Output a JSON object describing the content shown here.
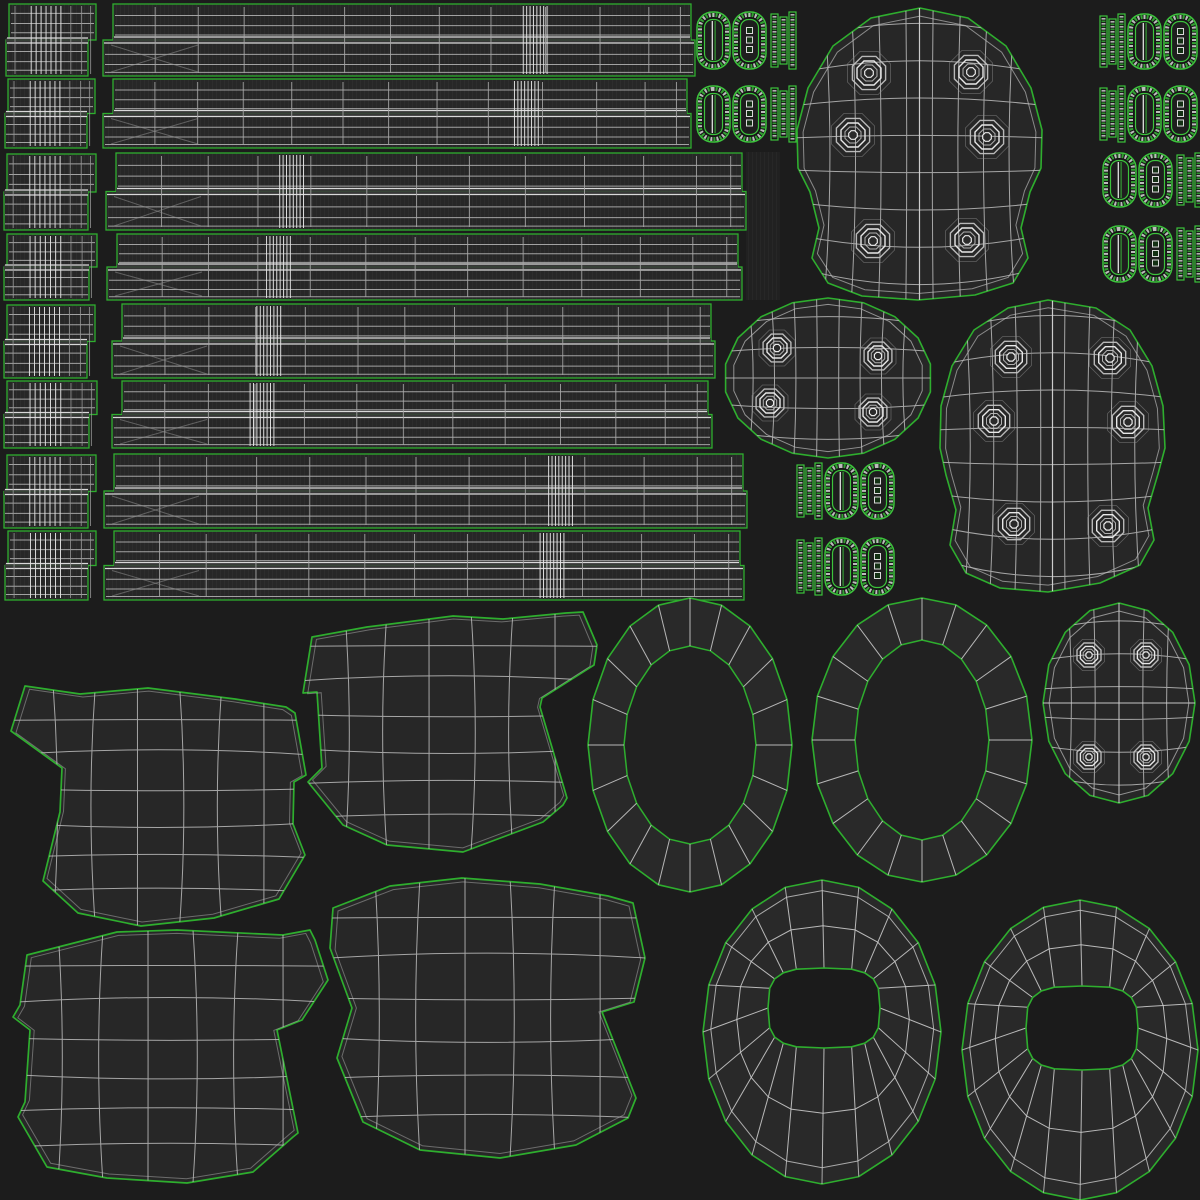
{
  "meta": {
    "title": "uv-wireframe-texture-sheet",
    "canvas": {
      "width": 1200,
      "height": 1200
    }
  },
  "colors": {
    "background": "#1c1c1c",
    "island_fill": "#272727",
    "island_texture_line": "#2d2d2d",
    "hardware_fill": "#161616",
    "ring_band_fill": "#292929",
    "ring_center_fill": "#212121",
    "hole_fill": "#1b1b1b",
    "seam_green": "#2eae2e",
    "seam_green_bright": "#3cc43c",
    "wire": "#c0c0c0",
    "wire_bright": "#e8e8e8",
    "wire_dim": "#8f8f8f",
    "band_fill": "#383838",
    "band_line": "#d8d8d8",
    "texture_block_fill": "#212121",
    "texture_block_line": "#272727"
  },
  "shapes": {
    "strip_rows": [
      {
        "block": {
          "x": 6,
          "y": 4,
          "w": 90,
          "h": 72
        },
        "strip": {
          "x": 103,
          "y": 4,
          "w": 592,
          "h": 72
        },
        "cluster_fx": 0.73
      },
      {
        "block": {
          "x": 5,
          "y": 79,
          "w": 90,
          "h": 69
        },
        "strip": {
          "x": 103,
          "y": 79,
          "w": 588,
          "h": 69
        },
        "cluster_fx": 0.72
      },
      {
        "block": {
          "x": 4,
          "y": 154,
          "w": 92,
          "h": 76
        },
        "strip": {
          "x": 106,
          "y": 153,
          "w": 640,
          "h": 77
        },
        "cluster_fx": 0.29
      },
      {
        "block": {
          "x": 4,
          "y": 234,
          "w": 93,
          "h": 66
        },
        "strip": {
          "x": 107,
          "y": 234,
          "w": 635,
          "h": 66
        },
        "cluster_fx": 0.27
      },
      {
        "block": {
          "x": 4,
          "y": 305,
          "w": 91,
          "h": 73
        },
        "strip": {
          "x": 112,
          "y": 304,
          "w": 603,
          "h": 74
        },
        "cluster_fx": 0.26
      },
      {
        "block": {
          "x": 4,
          "y": 381,
          "w": 93,
          "h": 67
        },
        "strip": {
          "x": 112,
          "y": 381,
          "w": 600,
          "h": 67
        },
        "cluster_fx": 0.25
      },
      {
        "block": {
          "x": 4,
          "y": 455,
          "w": 92,
          "h": 73
        },
        "strip": {
          "x": 104,
          "y": 454,
          "w": 643,
          "h": 74
        },
        "cluster_fx": 0.71
      },
      {
        "block": {
          "x": 5,
          "y": 531,
          "w": 91,
          "h": 69
        },
        "strip": {
          "x": 104,
          "y": 531,
          "w": 640,
          "h": 69
        },
        "cluster_fx": 0.7
      }
    ],
    "hardware_clusters": [
      {
        "x": 697,
        "y": 12,
        "h": 57,
        "order": "rings-strips"
      },
      {
        "x": 697,
        "y": 86,
        "h": 56,
        "order": "rings-strips"
      },
      {
        "x": 1100,
        "y": 14,
        "h": 55,
        "order": "strips-rings"
      },
      {
        "x": 1100,
        "y": 86,
        "h": 56,
        "order": "strips-rings"
      },
      {
        "x": 1103,
        "y": 153,
        "h": 54,
        "order": "rings-strips"
      },
      {
        "x": 1103,
        "y": 226,
        "h": 56,
        "order": "rings-strips"
      },
      {
        "x": 797,
        "y": 463,
        "h": 56,
        "order": "strips-rings"
      },
      {
        "x": 797,
        "y": 538,
        "h": 57,
        "order": "strips-rings"
      }
    ],
    "texture_blocks": [
      {
        "x": 746,
        "y": 152,
        "w": 34,
        "h": 148
      },
      {
        "x": 688,
        "y": 532,
        "w": 52,
        "h": 66
      }
    ],
    "domes": [
      {
        "outline": [
          [
            920,
            8
          ],
          [
            968,
            18
          ],
          [
            1006,
            46
          ],
          [
            1031,
            88
          ],
          [
            1042,
            130
          ],
          [
            1041,
            168
          ],
          [
            1030,
            192
          ],
          [
            1021,
            228
          ],
          [
            1028,
            258
          ],
          [
            1013,
            283
          ],
          [
            975,
            295
          ],
          [
            918,
            300
          ],
          [
            862,
            296
          ],
          [
            828,
            283
          ],
          [
            812,
            258
          ],
          [
            819,
            228
          ],
          [
            810,
            192
          ],
          [
            798,
            168
          ],
          [
            797,
            130
          ],
          [
            808,
            88
          ],
          [
            833,
            46
          ],
          [
            871,
            18
          ]
        ],
        "bolts": [
          [
            869,
            73
          ],
          [
            971,
            72
          ],
          [
            853,
            135
          ],
          [
            987,
            137
          ],
          [
            873,
            241
          ],
          [
            967,
            240
          ]
        ],
        "bolt_r": 18,
        "cols": 9,
        "rows": 9
      },
      {
        "outline": [
          [
            1048,
            300
          ],
          [
            1096,
            308
          ],
          [
            1130,
            330
          ],
          [
            1152,
            366
          ],
          [
            1163,
            406
          ],
          [
            1165,
            448
          ],
          [
            1158,
            474
          ],
          [
            1148,
            508
          ],
          [
            1154,
            540
          ],
          [
            1140,
            565
          ],
          [
            1100,
            583
          ],
          [
            1048,
            592
          ],
          [
            1000,
            588
          ],
          [
            966,
            573
          ],
          [
            950,
            545
          ],
          [
            956,
            510
          ],
          [
            946,
            475
          ],
          [
            940,
            448
          ],
          [
            941,
            406
          ],
          [
            952,
            366
          ],
          [
            974,
            330
          ],
          [
            1008,
            308
          ]
        ],
        "bolts": [
          [
            1011,
            357
          ],
          [
            1110,
            358
          ],
          [
            994,
            421
          ],
          [
            1128,
            422
          ],
          [
            1014,
            524
          ],
          [
            1108,
            526
          ]
        ],
        "bolt_r": 17,
        "cols": 9,
        "rows": 9
      }
    ],
    "bolted_ovals": [
      {
        "cx": 828,
        "cy": 378,
        "rx": 104,
        "ry": 80,
        "n": 18,
        "cols": 9,
        "rows": 6,
        "bolt_r": 15,
        "cross": false,
        "bolts": [
          [
            777,
            348
          ],
          [
            878,
            356
          ],
          [
            770,
            403
          ],
          [
            873,
            412
          ]
        ]
      },
      {
        "cx": 1119,
        "cy": 703,
        "rx": 76,
        "ry": 100,
        "n": 16,
        "cols": 6,
        "rows": 7,
        "bolt_r": 13,
        "cross": true,
        "bolts": [
          [
            1089,
            655
          ],
          [
            1146,
            655
          ],
          [
            1089,
            757
          ],
          [
            1146,
            757
          ]
        ]
      }
    ],
    "rings": [
      {
        "cx": 690,
        "cy": 745,
        "orx": 102,
        "ory": 147,
        "irx": 66,
        "iry": 99,
        "n": 20
      },
      {
        "cx": 922,
        "cy": 740,
        "orx": 110,
        "ory": 142,
        "irx": 67,
        "iry": 100,
        "n": 20
      }
    ],
    "ring_holes": [
      {
        "cx": 822,
        "cy": 1032,
        "orx": 119,
        "ory": 152,
        "hcx": 824,
        "hcy": 1008,
        "hrx": 56,
        "hry": 40,
        "n": 20
      },
      {
        "cx": 1080,
        "cy": 1050,
        "orx": 118,
        "ory": 150,
        "hcx": 1082,
        "hcy": 1028,
        "hrx": 56,
        "hry": 42,
        "n": 20
      }
    ],
    "pads": [
      {
        "outline": [
          [
            25,
            686
          ],
          [
            80,
            694
          ],
          [
            148,
            688
          ],
          [
            235,
            699
          ],
          [
            286,
            707
          ],
          [
            295,
            713
          ],
          [
            306,
            775
          ],
          [
            294,
            782
          ],
          [
            293,
            824
          ],
          [
            305,
            855
          ],
          [
            279,
            899
          ],
          [
            214,
            918
          ],
          [
            141,
            926
          ],
          [
            78,
            913
          ],
          [
            43,
            881
          ],
          [
            60,
            812
          ],
          [
            62,
            768
          ],
          [
            11,
            731
          ]
        ],
        "cols": 7,
        "rows": 7
      },
      {
        "outline": [
          [
            312,
            637
          ],
          [
            367,
            627
          ],
          [
            453,
            616
          ],
          [
            503,
            619
          ],
          [
            566,
            613
          ],
          [
            583,
            612
          ],
          [
            597,
            645
          ],
          [
            594,
            665
          ],
          [
            542,
            698
          ],
          [
            540,
            707
          ],
          [
            567,
            798
          ],
          [
            563,
            805
          ],
          [
            543,
            822
          ],
          [
            463,
            852
          ],
          [
            387,
            845
          ],
          [
            343,
            825
          ],
          [
            308,
            782
          ],
          [
            322,
            768
          ],
          [
            317,
            692
          ],
          [
            303,
            693
          ]
        ],
        "cols": 7,
        "rows": 7
      },
      {
        "outline": [
          [
            27,
            955
          ],
          [
            117,
            932
          ],
          [
            177,
            930
          ],
          [
            283,
            935
          ],
          [
            310,
            930
          ],
          [
            315,
            940
          ],
          [
            328,
            980
          ],
          [
            302,
            1020
          ],
          [
            277,
            1030
          ],
          [
            298,
            1133
          ],
          [
            293,
            1137
          ],
          [
            253,
            1172
          ],
          [
            187,
            1183
          ],
          [
            107,
            1178
          ],
          [
            47,
            1167
          ],
          [
            18,
            1117
          ],
          [
            25,
            1102
          ],
          [
            30,
            1030
          ],
          [
            13,
            1017
          ],
          [
            20,
            1005
          ]
        ],
        "cols": 7,
        "rows": 7
      },
      {
        "outline": [
          [
            333,
            908
          ],
          [
            390,
            886
          ],
          [
            462,
            878
          ],
          [
            540,
            884
          ],
          [
            608,
            896
          ],
          [
            633,
            903
          ],
          [
            645,
            958
          ],
          [
            634,
            1002
          ],
          [
            602,
            1012
          ],
          [
            636,
            1098
          ],
          [
            628,
            1118
          ],
          [
            576,
            1145
          ],
          [
            500,
            1158
          ],
          [
            420,
            1150
          ],
          [
            363,
            1122
          ],
          [
            337,
            1058
          ],
          [
            352,
            1008
          ],
          [
            330,
            948
          ]
        ],
        "cols": 7,
        "rows": 7
      }
    ]
  }
}
